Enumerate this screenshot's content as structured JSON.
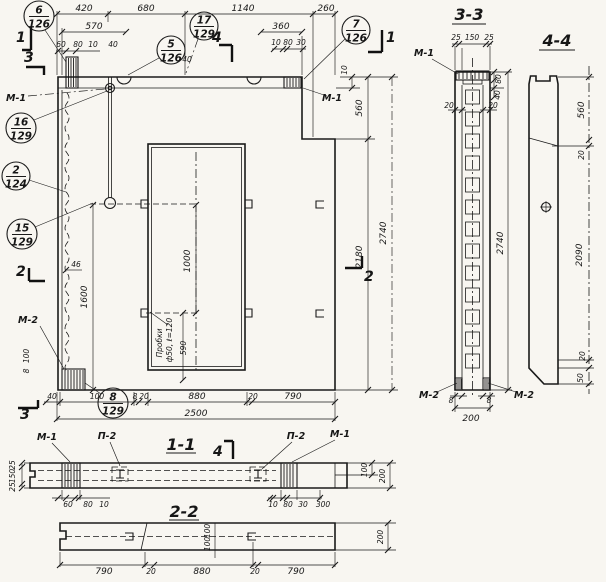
{
  "drawing": {
    "callouts": {
      "c6": {
        "num": "6",
        "sheet": "126"
      },
      "c17": {
        "num": "17",
        "sheet": "129"
      },
      "c7": {
        "num": "7",
        "sheet": "126"
      },
      "c5": {
        "num": "5",
        "sheet": "126"
      },
      "c16": {
        "num": "16",
        "sheet": "129"
      },
      "c2": {
        "num": "2",
        "sheet": "124"
      },
      "c15": {
        "num": "15",
        "sheet": "129"
      },
      "c8": {
        "num": "8",
        "sheet": "129"
      }
    },
    "marks": {
      "m1": "М-1",
      "m2": "М-2",
      "p2": "П-2"
    },
    "cuts": {
      "c1": "1",
      "c2": "2",
      "c3": "3",
      "c4": "4"
    },
    "titles": {
      "s11": "1-1",
      "s22": "2-2",
      "s33": "3-3",
      "s44": "4-4"
    },
    "main": {
      "top1": [
        "420",
        "680",
        "1140",
        "260"
      ],
      "top2": [
        "570",
        "360"
      ],
      "top3": [
        "60",
        "80",
        "10",
        "40",
        "40",
        "10",
        "80",
        "30"
      ],
      "right": [
        "10",
        "560",
        "2180",
        "2740"
      ],
      "left": [
        "46",
        "1600"
      ],
      "m2dims": [
        "100",
        "8",
        "40",
        "100",
        "8"
      ],
      "bottom": [
        "20",
        "880",
        "20",
        "790"
      ],
      "total": "2500",
      "opening": [
        "1000",
        "590"
      ],
      "plug_note1": "Пробки",
      "plug_note2": "ф50, ℓ=120"
    },
    "s11": {
      "left": [
        "25",
        "150",
        "25"
      ],
      "bl": [
        "60",
        "80",
        "10"
      ],
      "br": [
        "10",
        "80",
        "30",
        "300"
      ],
      "right": [
        "100",
        "200"
      ]
    },
    "s22": {
      "bottom": [
        "790",
        "20",
        "880",
        "20",
        "790"
      ],
      "mid": [
        "100",
        "100"
      ],
      "right": "200"
    },
    "s33": {
      "top": [
        "25",
        "150",
        "25"
      ],
      "side": [
        "80",
        "40"
      ],
      "waist": [
        "20",
        "20"
      ],
      "height": "2740",
      "b8": [
        "8",
        "8"
      ],
      "width": "200"
    },
    "s44": {
      "dims": [
        "560",
        "20",
        "2090",
        "20",
        "50"
      ]
    }
  }
}
